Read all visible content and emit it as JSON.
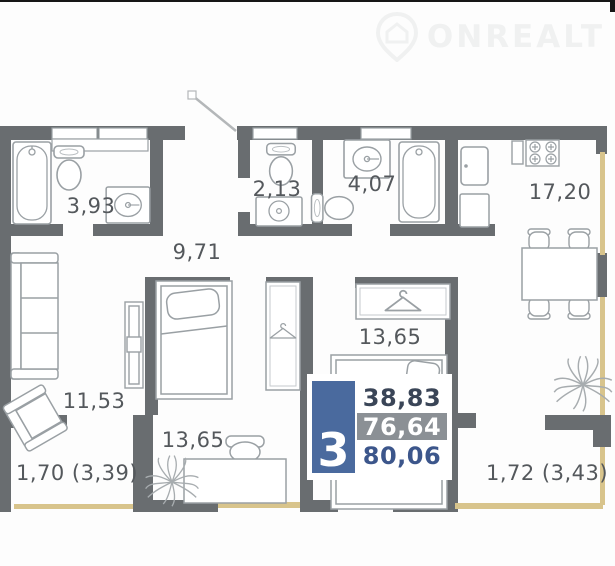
{
  "watermark": {
    "brand": "ONREALT"
  },
  "rooms": {
    "bathroom_small": {
      "label": "3,93"
    },
    "wc": {
      "label": "2,13"
    },
    "bathroom_large": {
      "label": "4,07"
    },
    "kitchen": {
      "label": "17,20"
    },
    "hallway": {
      "label": "9,71"
    },
    "living": {
      "label": "11,53"
    },
    "bedroom_left": {
      "label": "13,65"
    },
    "bedroom_right": {
      "label": "13,65"
    },
    "balcony_left": {
      "label": "1,70 (3,39)"
    },
    "balcony_right": {
      "label": "1,72 (3,43)"
    }
  },
  "stats": {
    "rooms_count": "3",
    "living_area": "38,83",
    "apartment_area": "76,64",
    "total_area": "80,06"
  },
  "colors": {
    "wall": "#696d70",
    "fixture_stroke": "#9aa0a4",
    "window": "#d8c48c",
    "accent_blue": "#4a6a9e",
    "row_gray": "#8b9095",
    "label_text": "#54585c"
  },
  "icons": [
    "location-pin-icon",
    "house-icon",
    "bathtub-icon",
    "toilet-icon",
    "sink-icon",
    "stove-icon",
    "fridge-icon",
    "dining-table-icon",
    "chair-icon",
    "sofa-icon",
    "armchair-icon",
    "bed-icon",
    "wardrobe-icon",
    "hanger-icon",
    "desk-icon",
    "plant-icon",
    "door-swing-icon"
  ]
}
